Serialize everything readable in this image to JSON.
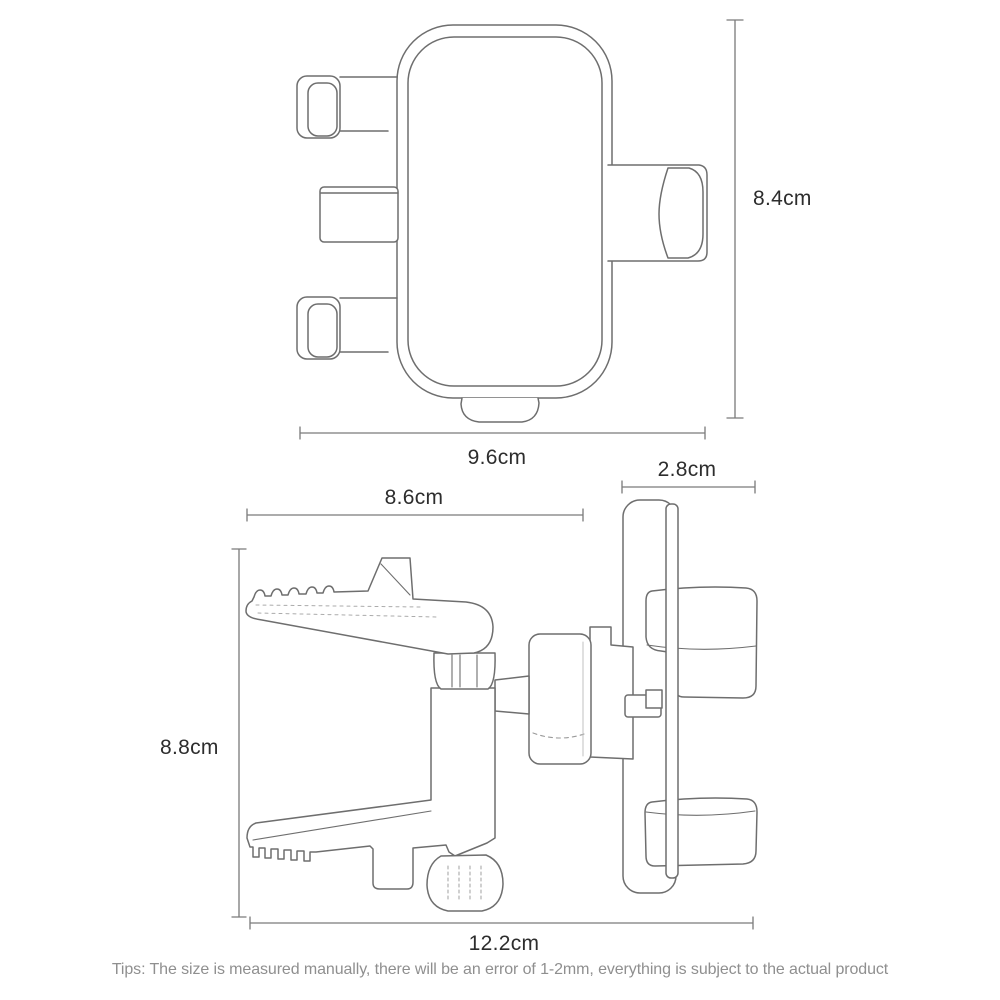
{
  "colors": {
    "background": "#ffffff",
    "line": "#6e6e6e",
    "label": "#2d2d2d",
    "tips": "#8f8f8f"
  },
  "dimensions": {
    "front_height": {
      "label": "8.4cm"
    },
    "front_width": {
      "label": "9.6cm"
    },
    "hook_depth": {
      "label": "2.8cm"
    },
    "clip_length": {
      "label": "8.6cm"
    },
    "side_height": {
      "label": "8.8cm"
    },
    "side_width": {
      "label": "12.2cm"
    }
  },
  "footer": {
    "tips": "Tips: The size is measured manually, there will be an error of 1-2mm, everything is subject to the actual product"
  }
}
